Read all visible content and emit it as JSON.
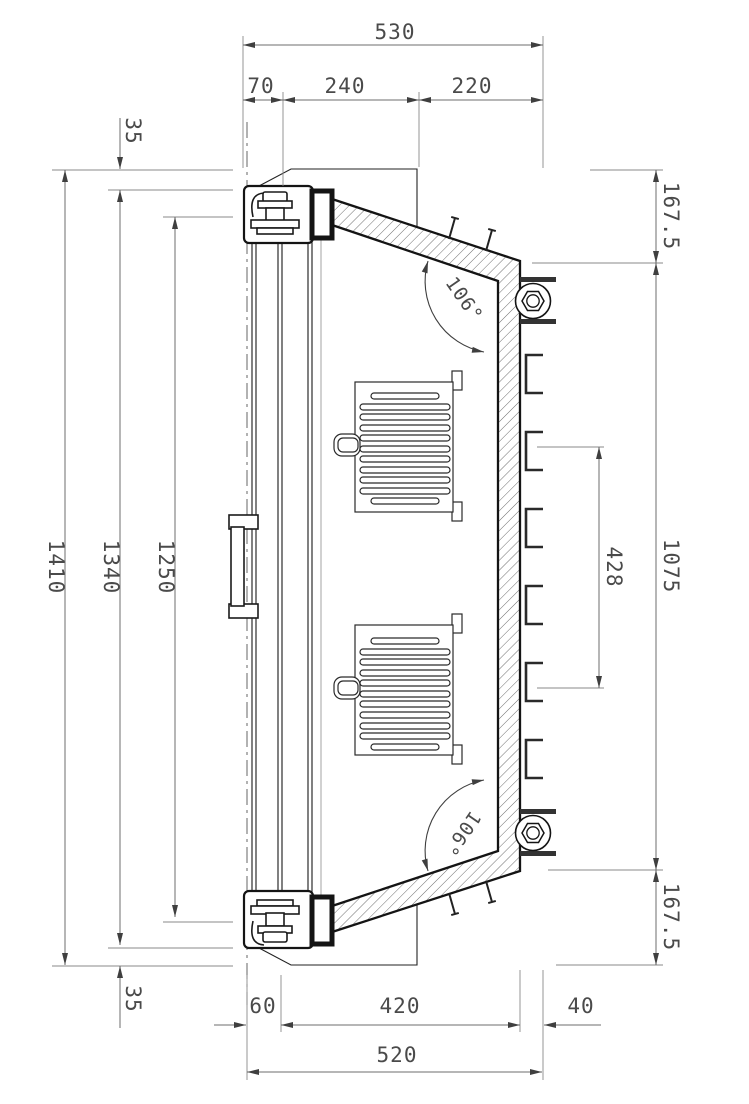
{
  "drawing": {
    "type": "technical-section-drawing",
    "dimensions": {
      "top": {
        "overall": "530",
        "seg1": "70",
        "seg2": "240",
        "seg3": "220"
      },
      "left": {
        "offset_top": "35",
        "overall": "1410",
        "inner": "1340",
        "panel": "1250",
        "offset_bottom": "35"
      },
      "right": {
        "top": "167.5",
        "span": "1075",
        "clip_span": "428",
        "bottom": "167.5"
      },
      "bottom": {
        "seg1": "60",
        "seg2": "420",
        "seg3": "40",
        "overall": "520"
      },
      "angles": {
        "top": "106°",
        "bottom": "106°"
      }
    },
    "colors": {
      "geometry_line": "#141414",
      "dimension_line": "#6e6e6e",
      "extension_line": "#8a8a8a",
      "text": "#4a4a4a",
      "background": "#ffffff"
    }
  }
}
